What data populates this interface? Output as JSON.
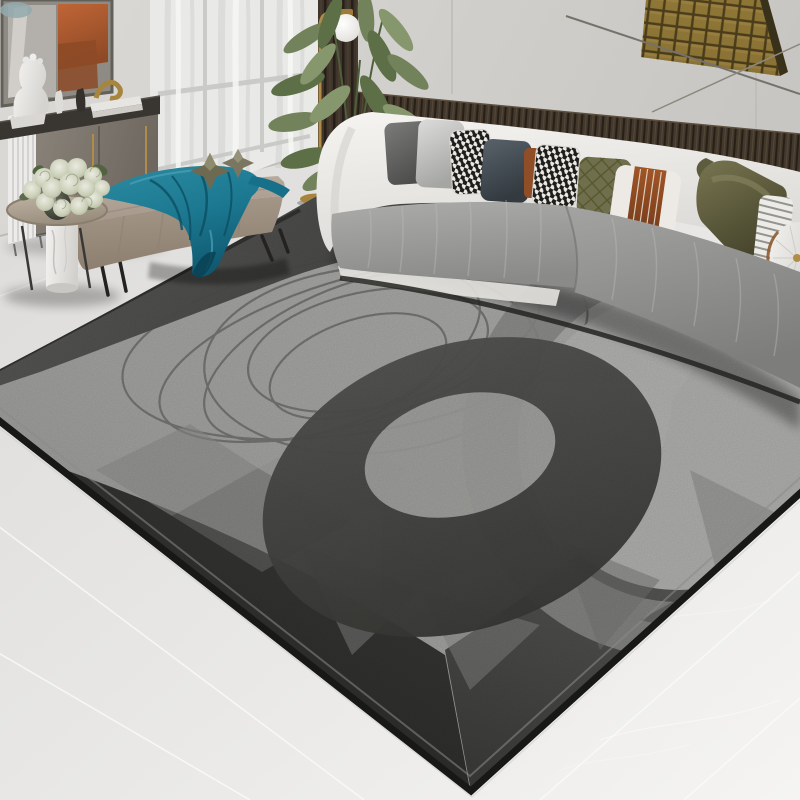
{
  "scene": {
    "caption": "Modern living room product photo: large abstract grey swirl area rug with charcoal corner, scribbled ellipse lines and geometric facets, curved white-and-grey fabric sofa with patterned throw pillows, taupe tufted ottoman bench with teal velvet throw and metallic star ornaments, round side table with marble base and pale rose bouquet, grey sideboard with white bust sculpture and gold decor, sheer curtains, dark wood slat wall panels, gold mosaic wall art, brass globe floor lamp, green plant, light marble tile floor",
    "palette": {
      "wall": "#d5d3cf",
      "wall-panel": "#cfcdc9",
      "curtain": "#e9e9e7",
      "wood-dark": "#3f352a",
      "wood-gap": "#261f19",
      "gold": "#b08c46",
      "mosaic-gold": "#8d7536",
      "mosaic-gap": "#453818",
      "art-orange": "#b96134",
      "art-teal": "#93a9ad",
      "floor": "#dfdedc",
      "floor-bright": "#f4f3f1",
      "grout": "#fafaf8",
      "rug-field": "#a9a9a7",
      "rug-field-light": "#b6b6b4",
      "rug-circle": "#b6b6b4",
      "rug-ring": "#8b8b89",
      "rug-band": "#545452",
      "rug-swirl": "#464644",
      "rug-charcoal": "#2c2c2a",
      "rug-binding": "#181816",
      "rug-scribble": "#6f6f6d",
      "sofa-white": "#f2f0ed",
      "cushion-grey": "#9c9c9a",
      "pillow-dark-grey": "#646462",
      "pillow-silver": "#c6c6c4",
      "pillow-slate": "#475056",
      "pillow-rust": "#8f4d28",
      "pillow-olive": "#6f6f4e",
      "pillow-olive-satin": "#5e5c3e",
      "houndstooth-dark": "#1d1d1b",
      "houndstooth-light": "#ece9e4",
      "ottoman-top": "#b5a896",
      "ottoman-front": "#a0917f",
      "blanket-teal": "#1b7890",
      "blanket-teal-dark": "#0d4f63",
      "plant-green": "#72825a",
      "plant-green-dark": "#52643f",
      "marble-white": "#efeeec",
      "table-top": "#b1a695",
      "bust-white": "#f2f1ef",
      "metal-black": "#242220"
    },
    "objects": [
      {
        "name": "area-rug",
        "description": "abstract grey rug with swirl ribbon, scribble ellipses, facet polygons, charcoal corner, black binding"
      },
      {
        "name": "curved-sofa",
        "description": "white shell sofa with grey velvet seat cushions"
      },
      {
        "name": "pillows",
        "items": [
          "dark-grey-velvet",
          "silver-velvet",
          "houndstooth",
          "slate-blue",
          "rust-sliver",
          "houndstooth-2",
          "olive-quilted",
          "white-rust-stripe-panel",
          "olive-satin",
          "ticking-stripe",
          "white-bolster"
        ]
      },
      {
        "name": "ottoman-bench",
        "description": "taupe tufted bench on black metal legs"
      },
      {
        "name": "teal-throw-blanket",
        "description": "teal velvet throw draped over ottoman"
      },
      {
        "name": "star-ornaments",
        "description": "two metallic origami star decorations"
      },
      {
        "name": "side-table",
        "description": "round taupe-top table with white marble cylinder base"
      },
      {
        "name": "flower-bouquet",
        "description": "pale sage and cream roses in dark glass vase"
      },
      {
        "name": "sideboard-cabinet",
        "description": "grey-taupe cabinet, dark stone top, brass handles"
      },
      {
        "name": "bust-sculpture",
        "description": "white classical bust"
      },
      {
        "name": "decor",
        "items": [
          "white-figurine",
          "dark-figurine",
          "gold-abstract-sculpture",
          "white-books"
        ]
      },
      {
        "name": "slatted-console",
        "description": "white vertical-slat unit"
      },
      {
        "name": "mirror-art",
        "description": "framed mirror with orange abstract reflection"
      },
      {
        "name": "gold-mosaic-art",
        "description": "brass tile grid wall art"
      },
      {
        "name": "wood-slat-panel",
        "description": "dark walnut slat band behind sofa"
      },
      {
        "name": "sheer-curtain",
        "description": "white sheer curtain over window"
      },
      {
        "name": "floor-lamp",
        "description": "brass floor lamp with white globe"
      },
      {
        "name": "potted-plant",
        "description": "tall green leafy plant"
      },
      {
        "name": "marble-floor",
        "description": "light grey marble tiles with thin grout lines"
      }
    ]
  }
}
